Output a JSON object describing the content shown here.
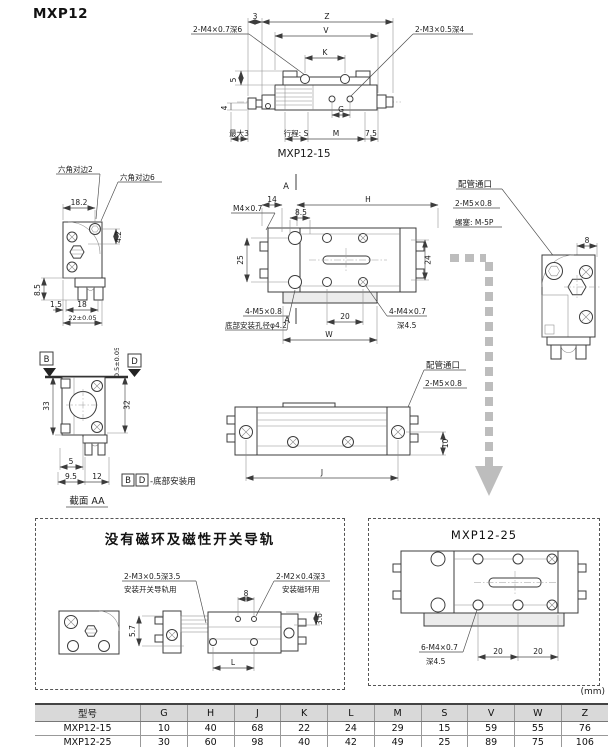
{
  "page": {
    "title": "MXP12",
    "units": "(mm)"
  },
  "top_view": {
    "caption": "MXP12-15",
    "thread_left": "2-M4×0.7深6",
    "thread_right": "2-M3×0.5深4",
    "dim_3": "3",
    "dim_z": "Z",
    "dim_v": "V",
    "dim_k": "K",
    "dim_5": "5",
    "dim_4": "4",
    "dim_max3": "最大3",
    "dim_stroke": "行程: S",
    "dim_m": "M",
    "dim_g": "G",
    "dim_75": "7.5"
  },
  "end_view": {
    "hex2": "六角对边2",
    "hex6": "六角对边6",
    "dim_182": "18.2",
    "dim_42": "4.2",
    "dim_85": "8.5",
    "dim_15": "1.5",
    "dim_18": "18",
    "dim_22": "22±0.05"
  },
  "plan_view": {
    "sec_a_top": "A",
    "sec_a_bottom": "A",
    "dim_14": "14",
    "dim_h": "H",
    "dim_85": "8.5",
    "m4": "M4×0.7",
    "dim_25": "25",
    "dim_24": "24",
    "m5": "4-M5×0.8",
    "bottom_hole": "底部安装孔径φ4.2",
    "dim_20": "20",
    "m4b": "4-M4×0.7",
    "depth_45": "深4.5",
    "dim_w": "W"
  },
  "side_view": {
    "port": "配管通口",
    "m5": "2-M5×0.8",
    "plug": "螺塞: M-5P",
    "dim_8": "8"
  },
  "section_view": {
    "b": "B",
    "d": "D",
    "dim_05": "0.5±0.05",
    "dim_33": "33",
    "dim_32": "32",
    "dim_5": "5",
    "dim_95": "9.5",
    "dim_12": "12",
    "note_b": "B",
    "note_d": "D",
    "note": "-底部安装用",
    "caption": "截面 AA"
  },
  "front_view": {
    "port": "配管通口",
    "m5": "2-M5×0.8",
    "dim_10": "10",
    "dim_j": "J"
  },
  "panel_no_magnet": {
    "title": "没有磁环及磁性开关导轨",
    "m3": "2-M3×0.5深3.5",
    "m3_note": "安装开关导轨用",
    "m2": "2-M2×0.4深3",
    "m2_note": "安装磁环用",
    "dim_8": "8",
    "dim_57": "5.7",
    "dim_36": "3.6",
    "dim_l": "L"
  },
  "panel_25": {
    "title": "MXP12-25",
    "m4": "6-M4×0.7",
    "depth": "深4.5",
    "dim_20a": "20",
    "dim_20b": "20"
  },
  "table": {
    "headers": [
      "型号",
      "G",
      "H",
      "J",
      "K",
      "L",
      "M",
      "S",
      "V",
      "W",
      "Z"
    ],
    "rows": [
      {
        "model": "MXP12-15",
        "values": [
          "10",
          "40",
          "68",
          "22",
          "24",
          "29",
          "15",
          "59",
          "55",
          "76"
        ]
      },
      {
        "model": "MXP12-25",
        "values": [
          "30",
          "60",
          "98",
          "40",
          "42",
          "49",
          "25",
          "89",
          "75",
          "106"
        ]
      }
    ]
  }
}
